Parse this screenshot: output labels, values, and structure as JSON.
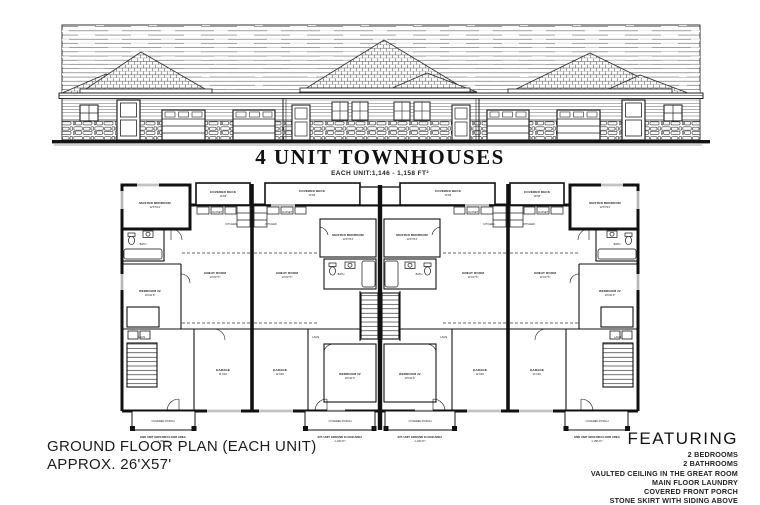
{
  "title": "4 UNIT TOWNHOUSES",
  "subtitle": "EACH UNIT:1,146 - 1,158 FT²",
  "plan_note": {
    "line1": "GROUND FLOOR PLAN (EACH UNIT)",
    "line2": "APPROX. 26'X57'"
  },
  "featuring": {
    "heading": "FEATURING",
    "items": [
      "2 BEDROOMS",
      "2 BATHROOMS",
      "VAULTED CEILING IN THE GREAT ROOM",
      "MAIN FLOOR LAUNDRY",
      "COVERED FRONT PORCH",
      "STONE SKIRT WITH SIDING ABOVE"
    ]
  },
  "plan": {
    "rooms": {
      "covered_deck": "COVERED DECK",
      "deck_dim": "10'X8'",
      "master": "MASTER BEDROOM",
      "master_dim": "12'6\"X13'",
      "closet": "CLOSET",
      "kitchen": "KITCHEN",
      "great": "GREAT ROOM",
      "great_dim": "13'X17'6\"",
      "bedroom2": "BEDROOM #2",
      "bedroom2_dim": "10'X11'6\"",
      "bath": "BATH",
      "laundry": "LAUN.",
      "garage": "GARAGE",
      "garage_dim": "11'X20'",
      "porch": "COVERED PORCH"
    },
    "areas": {
      "end_label": "END UNIT GROUND FLOOR AREA",
      "end_area": "1,158 FT²",
      "int_label": "INT. UNIT GROUND FLOOR AREA",
      "int_area": "1,146 FT²"
    }
  },
  "colors": {
    "ink": "#1c1c1c",
    "paper": "#ffffff"
  }
}
